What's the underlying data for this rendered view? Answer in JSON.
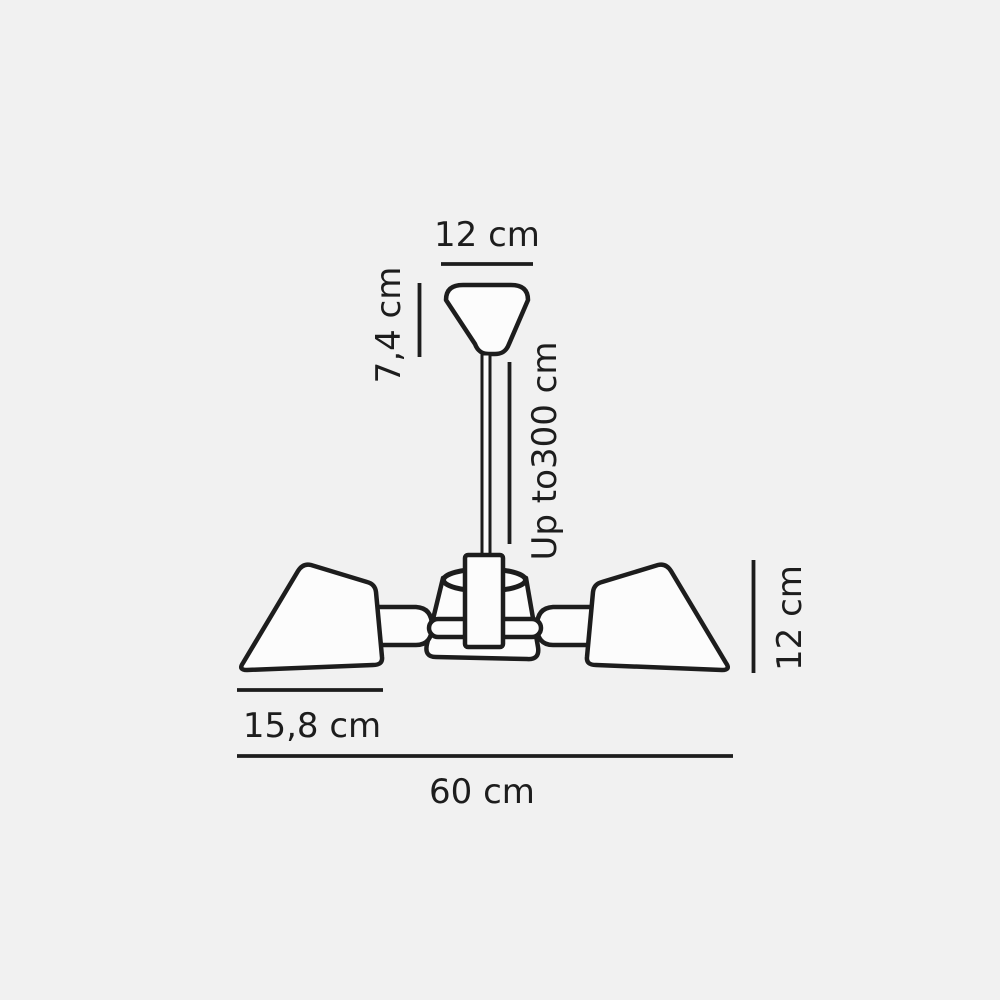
{
  "diagram": {
    "labels": {
      "canopy_width": "12 cm",
      "canopy_height": "7,4 cm",
      "suspension_length": "Up to300 cm",
      "shade_height": "12 cm",
      "shade_width": "15,8 cm",
      "fixture_width": "60 cm"
    },
    "colors": {
      "background": "#f1f1f1",
      "line": "#1d1d1d",
      "shape_fill": "#fcfcfc"
    }
  }
}
